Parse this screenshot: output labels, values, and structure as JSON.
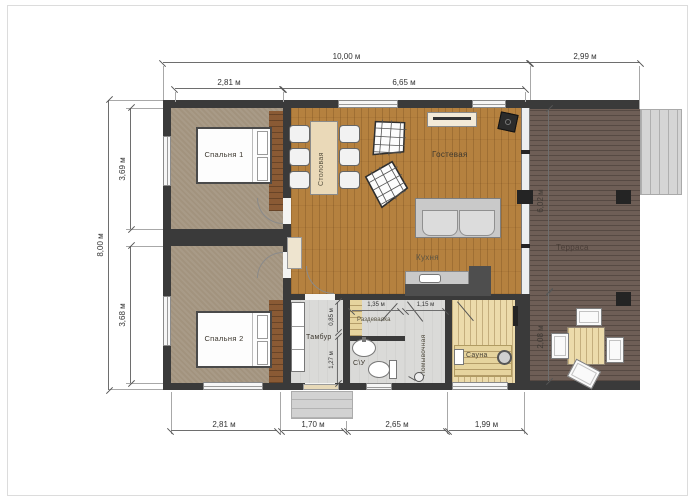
{
  "plan_title": "Floor plan with terrace",
  "rooms": {
    "bedroom1": "Спальня 1",
    "bedroom2": "Спальня 2",
    "dining": "Столовая",
    "living": "Гостевая",
    "kitchen": "Кухня",
    "vestibule": "Тамбур",
    "bathroom": "С\\У",
    "dressing": "Раздевалка",
    "washing": "Помывочная",
    "sauna": "Сауна",
    "terrace": "Терраса"
  },
  "dims": {
    "top": {
      "total": "10,00 м",
      "terrace": "2,99 м",
      "bedroom": "2,81 м",
      "living": "6,65 м"
    },
    "left": {
      "total": "8,00 м",
      "upper": "3,69 м",
      "lower": "3,68 м"
    },
    "bottom": {
      "bedroom": "2,81 м",
      "entry": "1,70 м",
      "bath": "2,65 м",
      "sauna": "1,99 м"
    },
    "terrace": {
      "upper": "6,02 м",
      "lower": "2,08 м"
    },
    "inner": {
      "vest_upper": "0,85 м",
      "vest_lower": "1,27 м",
      "dressing_w": "1,35 м",
      "washing_w": "1,15 м"
    }
  },
  "colors": {
    "wall": "#3a3a3a",
    "wood_floor": "#b5813f",
    "carpet": "#a2937e",
    "deck": "#6e5e56",
    "sauna_wood": "#ecdbab",
    "utility_floor": "#dadad8"
  }
}
